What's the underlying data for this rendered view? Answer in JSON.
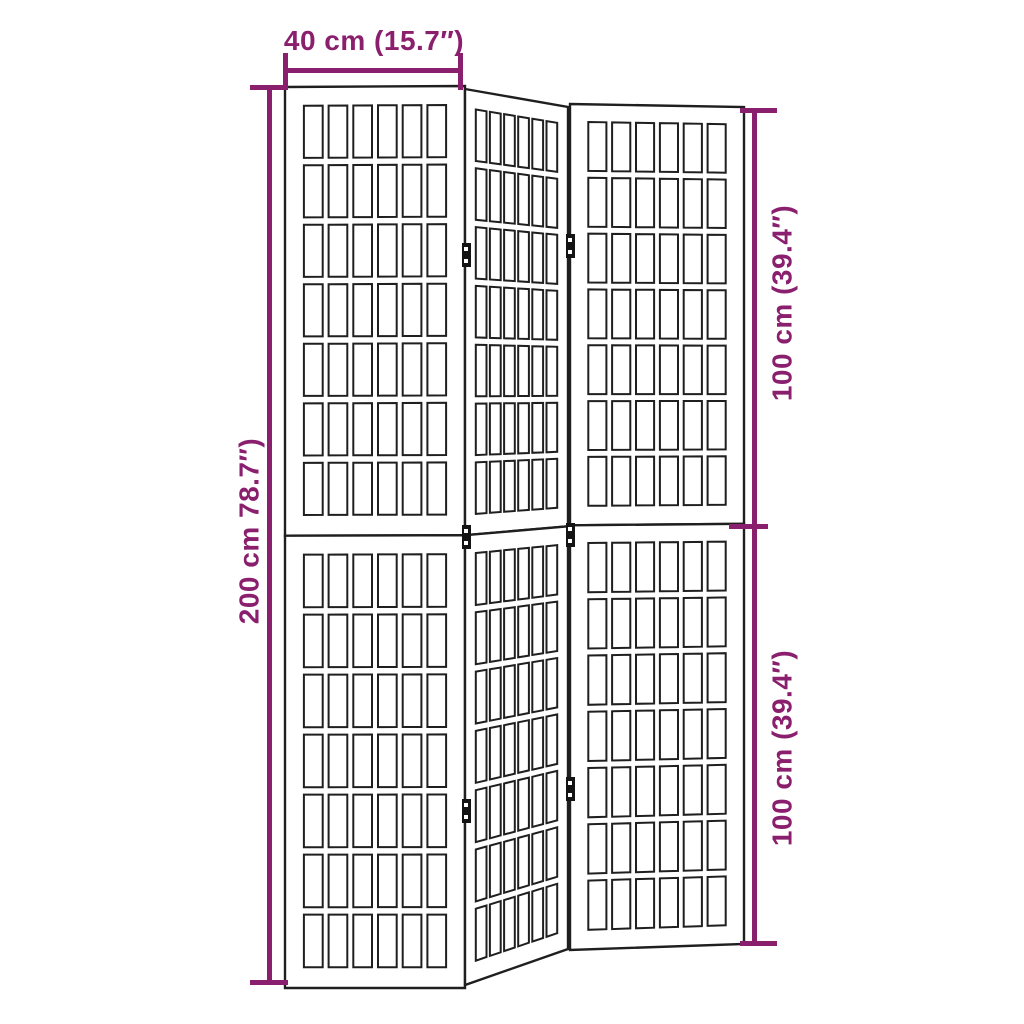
{
  "art": {
    "background": "#ffffff",
    "line_color": "#1f1f1f",
    "accent_color": "#8a1f6e"
  },
  "dimension_labels": {
    "top_width": "40 cm (15.7″)",
    "left_height": "200 cm 78.7″)",
    "right_top": "100 cm (39.4″)",
    "right_bottom": "100 cm (39.4″)"
  },
  "figure": {
    "subject": "3-panel folding room divider with japanese lattice screens",
    "panel_count": 3,
    "halves_per_panel": 2,
    "lattice_columns": 6,
    "lattice_rows_per_half": 7,
    "v_split": 0.498,
    "u_inset": 0.105,
    "gap_u": 0.033,
    "cell_u": 0.10417,
    "v_top": 0.042,
    "gap_v": 0.0165,
    "cell_v": 0.11614,
    "panels": [
      {
        "name": "left-panel",
        "quad": [
          [
            285,
            87
          ],
          [
            465,
            86
          ],
          [
            465,
            988
          ],
          [
            285,
            988
          ]
        ]
      },
      {
        "name": "middle-panel",
        "quad": [
          [
            465,
            89
          ],
          [
            568,
            107
          ],
          [
            568,
            949
          ],
          [
            465,
            985
          ]
        ]
      },
      {
        "name": "right-panel",
        "quad": [
          [
            570,
            104
          ],
          [
            744,
            107
          ],
          [
            744,
            944
          ],
          [
            570,
            950
          ]
        ]
      }
    ],
    "hinges": [
      {
        "x": 466,
        "y": 255
      },
      {
        "x": 466,
        "y": 537
      },
      {
        "x": 466,
        "y": 811
      },
      {
        "x": 570,
        "y": 246
      },
      {
        "x": 570,
        "y": 535
      },
      {
        "x": 570,
        "y": 789
      }
    ]
  }
}
